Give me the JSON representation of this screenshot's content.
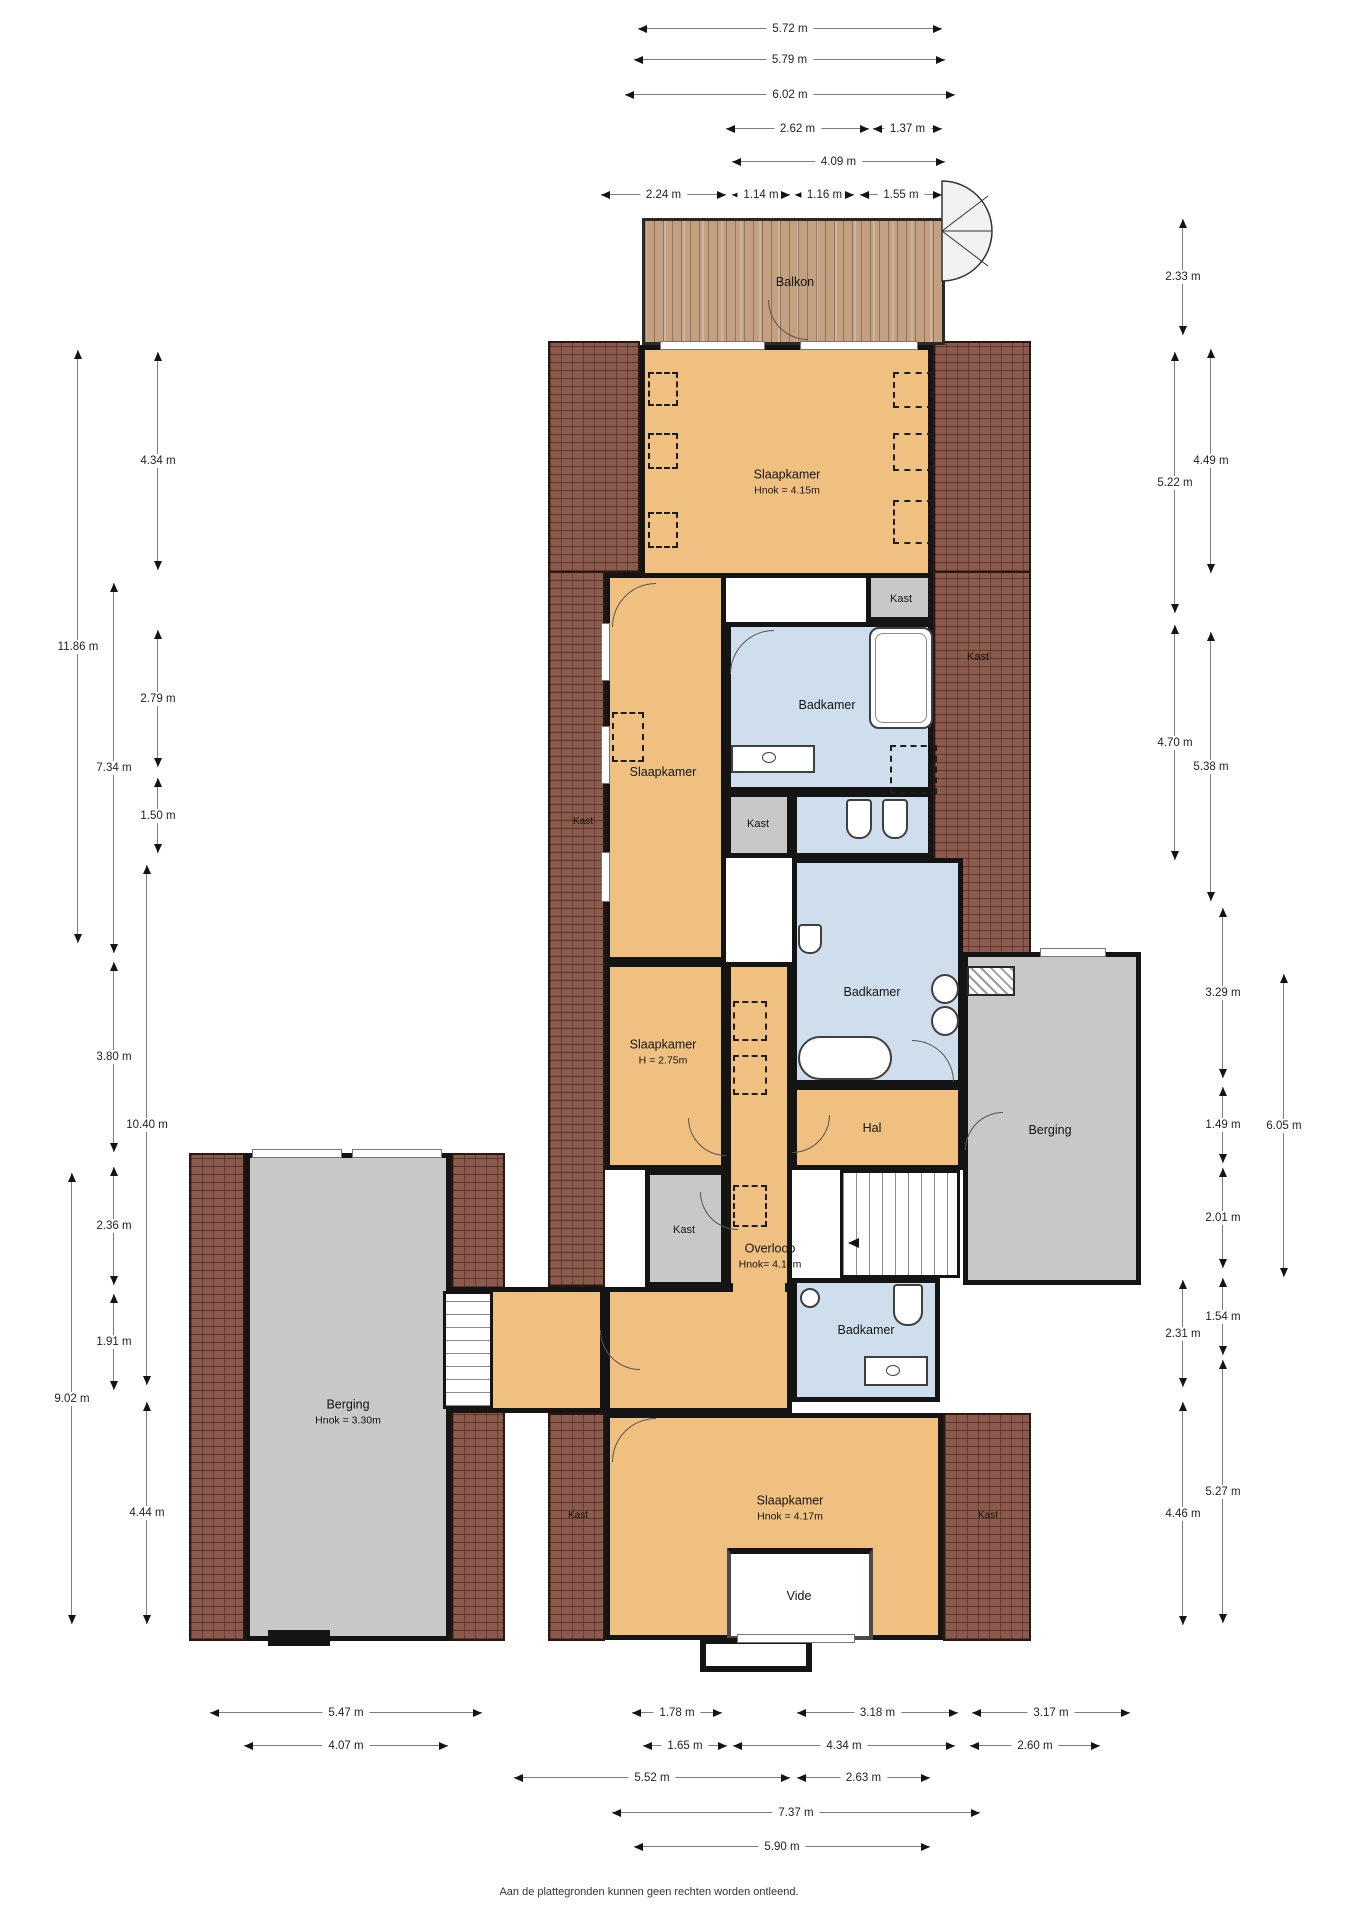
{
  "plan": {
    "labels": {
      "balkon": "Balkon",
      "slaapkamer1": {
        "name": "Slaapkamer",
        "sub": "Hnok = 4.15m"
      },
      "slaapkamer2": {
        "name": "Slaapkamer"
      },
      "slaapkamer3": {
        "name": "Slaapkamer",
        "sub": "H = 2.75m"
      },
      "slaapkamer4": {
        "name": "Slaapkamer",
        "sub": "Hnok = 4.17m"
      },
      "badkamer": "Badkamer",
      "kast": "Kast",
      "overloop": {
        "name": "Overloop",
        "sub": "Hnok= 4.12m"
      },
      "hal": "Hal",
      "berging_left": {
        "name": "Berging",
        "sub": "Hnok = 3.30m"
      },
      "berging_right": "Berging",
      "vide": "Vide"
    },
    "footer": "Aan de plattegronden kunnen geen rechten worden ontleend."
  },
  "dims": {
    "top": [
      "5.72 m",
      "5.79 m",
      "6.02 m",
      "2.62 m",
      "1.37 m",
      "4.09 m",
      "2.24 m",
      "1.14 m",
      "1.16 m",
      "1.55 m"
    ],
    "left": [
      "4.34 m",
      "11.86 m",
      "2.79 m",
      "7.34 m",
      "1.50 m",
      "3.80 m",
      "10.40 m",
      "2.36 m",
      "1.91 m",
      "9.02 m",
      "4.44 m"
    ],
    "right": [
      "2.33 m",
      "5.22 m",
      "4.49 m",
      "4.70 m",
      "5.38 m",
      "3.29 m",
      "1.49 m",
      "6.05 m",
      "2.01 m",
      "1.54 m",
      "2.31 m",
      "5.27 m",
      "4.46 m"
    ],
    "bottom": [
      "5.47 m",
      "1.78 m",
      "3.18 m",
      "3.17 m",
      "4.07 m",
      "1.65 m",
      "4.34 m",
      "2.60 m",
      "5.52 m",
      "2.63 m",
      "7.37 m",
      "5.90 m"
    ]
  }
}
